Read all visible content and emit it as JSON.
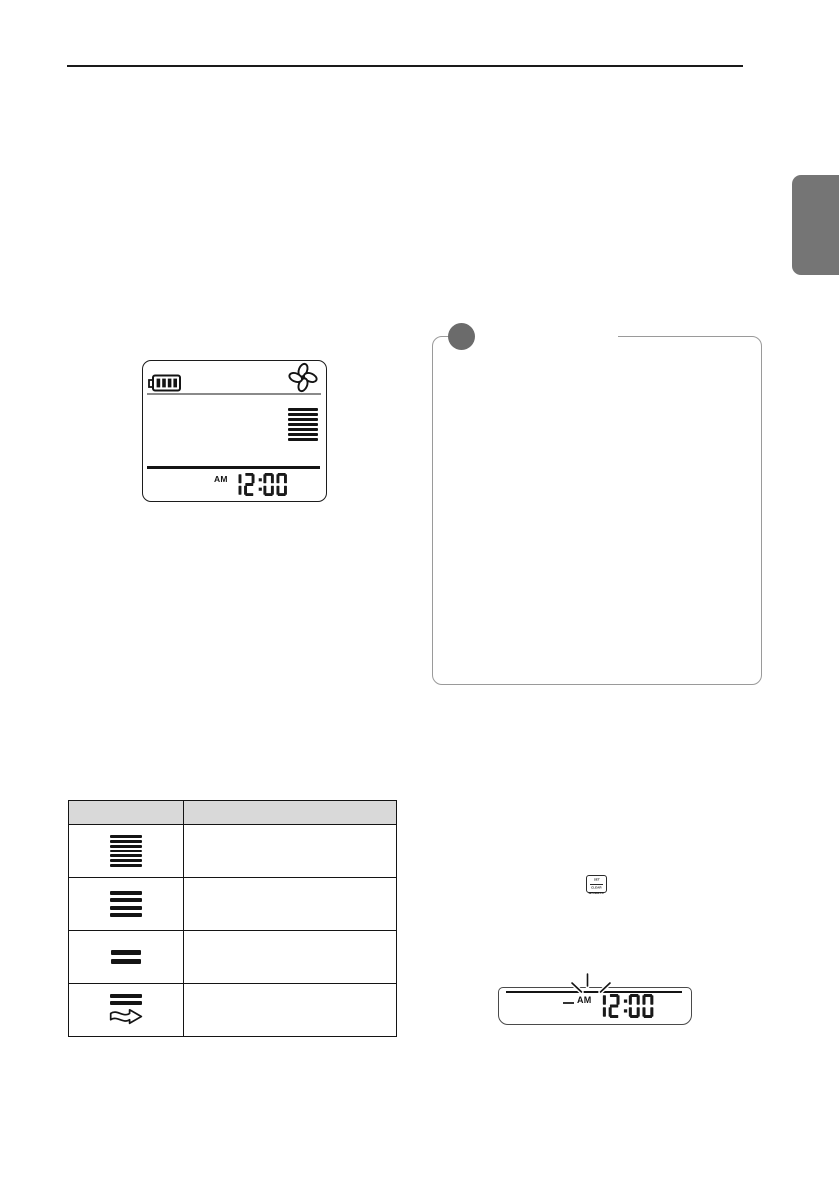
{
  "colors": {
    "tab_gray": "#757575",
    "note_marker_gray": "#6b6b6b",
    "table_header_gray": "#d9d9d9",
    "ink": "#141414",
    "callout_border": "#9a9a9a"
  },
  "main_display": {
    "battery": "battery-full",
    "fan": "fan-running",
    "fan_speed_bars": 7,
    "meridiem": "AM",
    "time": "12:00"
  },
  "note_callout": {
    "marker": "note-circle"
  },
  "fan_speed_table": {
    "header": [
      "",
      ""
    ],
    "rows": [
      {
        "icon_bars": 7,
        "has_arrow": false,
        "description": ""
      },
      {
        "icon_bars": 4,
        "has_arrow": false,
        "description": ""
      },
      {
        "icon_bars": 2,
        "has_arrow": false,
        "description": ""
      },
      {
        "icon_bars": 2,
        "has_arrow": true,
        "description": ""
      }
    ]
  },
  "set_clear_button": {
    "line1": "SET",
    "line2": "CLEAR",
    "caption": "WK/DAYS"
  },
  "strip_display": {
    "meridiem": "AM",
    "time": "12:00",
    "blinking": true
  }
}
